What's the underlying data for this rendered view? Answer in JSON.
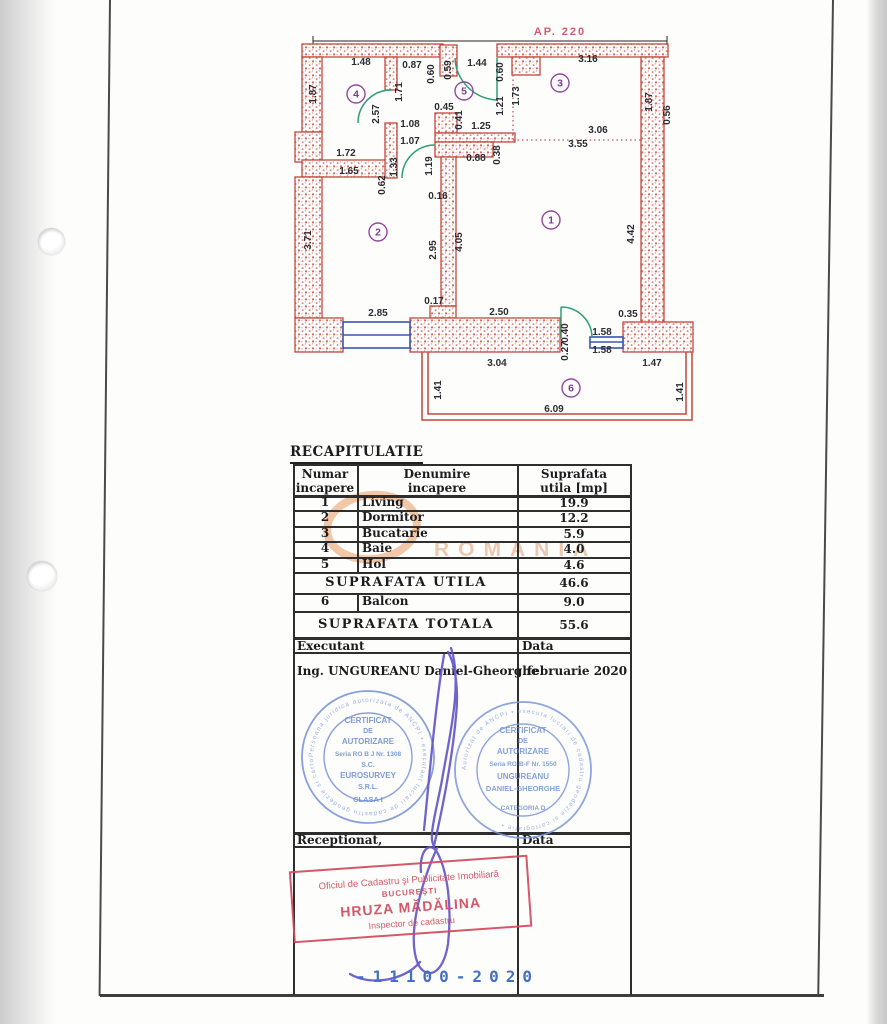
{
  "document": {
    "ap_label": "AP. 220",
    "recap": {
      "title": "RECAPITULATIE",
      "headers": {
        "col1": "Numar\nincapere",
        "col2": "Denumire\nincapere",
        "col3": "Suprafata\nutila [mp]"
      },
      "rows": [
        [
          "1",
          "Living",
          "19.9"
        ],
        [
          "2",
          "Dormitor",
          "12.2"
        ],
        [
          "3",
          "Bucatarie",
          "5.9"
        ],
        [
          "4",
          "Baie",
          "4.0"
        ],
        [
          "5",
          "Hol",
          "4.6"
        ]
      ],
      "suprafata_utila_label": "SUPRAFATA  UTILA",
      "suprafata_utila_value": "46.6",
      "balcon_row": [
        "6",
        "Balcon",
        "9.0"
      ],
      "suprafata_totala_label": "SUPRAFATA  TOTALA",
      "suprafata_totala_value": "55.6"
    },
    "executant": {
      "label": "Executant",
      "data_label": "Data",
      "name": "Ing. UNGUREANU Daniel-Gheorghe",
      "date": "februarie  2020"
    },
    "receptionat": {
      "label": "Receptionat,",
      "data_label": "Data"
    },
    "stamp_round_1": {
      "lines": [
        "CERTIFICAT",
        "DE",
        "AUTORIZARE",
        "Seria RO  B  J Nr. 1308",
        "S.C.",
        "EUROSURVEY",
        "S.R.L.",
        "CLASA I"
      ],
      "ring_text": "Persoana juridica autorizata de ANCPI • executant lucrari de cadastru geodezie si cartografie •"
    },
    "stamp_round_2": {
      "lines": [
        "CERTIFICAT",
        "DE",
        "AUTORIZARE",
        "Seria RO-B-F Nr. 1550",
        "UNGUREANU",
        "DANIEL-GHEORGHE"
      ],
      "bottom_arc": "CATEGORIA D",
      "ring_text": "Autorizat de ANCPI • executa lucrari de cadastru geodezie si cartografie •"
    },
    "stamp_rect": {
      "line1": "Oficiul de Cadastru şi Publicitate Imobiliară",
      "line2": "BUCUREŞTI",
      "line3": "HRUZA MĂDĂLINA",
      "line4": "Inspector de cadastru"
    },
    "registration_number": "-11100-2020",
    "watermark": "ROMANIA"
  },
  "plan": {
    "colors": {
      "wall": "#c4473c",
      "door": "#2f9e74",
      "window": "#3b55b5",
      "dim_text": "#2c2c34",
      "room_circle": "#93489c",
      "dotted": "#cc4a55"
    },
    "room_circles": [
      {
        "n": "1",
        "x": 551,
        "y": 220
      },
      {
        "n": "2",
        "x": 378,
        "y": 232
      },
      {
        "n": "3",
        "x": 560,
        "y": 83
      },
      {
        "n": "4",
        "x": 356,
        "y": 94
      },
      {
        "n": "5",
        "x": 464,
        "y": 91
      },
      {
        "n": "6",
        "x": 571,
        "y": 388
      }
    ],
    "labels": [
      {
        "t": "1.48",
        "x": 361,
        "y": 65
      },
      {
        "t": "0.87",
        "x": 412,
        "y": 68
      },
      {
        "t": "0.60",
        "x": 434,
        "y": 74,
        "v": 1
      },
      {
        "t": "0.59",
        "x": 451,
        "y": 70,
        "v": 1
      },
      {
        "t": "1.44",
        "x": 477,
        "y": 66
      },
      {
        "t": "0.60",
        "x": 503,
        "y": 72,
        "v": 1
      },
      {
        "t": "3.16",
        "x": 588,
        "y": 62
      },
      {
        "t": "1.87",
        "x": 316,
        "y": 94,
        "v": 1
      },
      {
        "t": "2.57",
        "x": 379,
        "y": 114,
        "v": 1
      },
      {
        "t": "1.71",
        "x": 402,
        "y": 92,
        "v": 1
      },
      {
        "t": "1.21",
        "x": 503,
        "y": 106,
        "v": 1
      },
      {
        "t": "1.73",
        "x": 519,
        "y": 96,
        "v": 1
      },
      {
        "t": "1.87",
        "x": 652,
        "y": 102,
        "v": 1
      },
      {
        "t": "0.56",
        "x": 670,
        "y": 115,
        "v": 1
      },
      {
        "t": "1.08",
        "x": 410,
        "y": 127
      },
      {
        "t": "1.07",
        "x": 410,
        "y": 144
      },
      {
        "t": "0.45",
        "x": 444,
        "y": 110
      },
      {
        "t": "0.41",
        "x": 462,
        "y": 120,
        "v": 1
      },
      {
        "t": "1.25",
        "x": 481,
        "y": 129
      },
      {
        "t": "3.06",
        "x": 598,
        "y": 133
      },
      {
        "t": "3.55",
        "x": 578,
        "y": 147
      },
      {
        "t": "0.88",
        "x": 476,
        "y": 161
      },
      {
        "t": "0.38",
        "x": 500,
        "y": 155,
        "v": 1
      },
      {
        "t": "1.72",
        "x": 346,
        "y": 156
      },
      {
        "t": "1.65",
        "x": 349,
        "y": 174
      },
      {
        "t": "0.62",
        "x": 385,
        "y": 185,
        "v": 1
      },
      {
        "t": "1.33",
        "x": 397,
        "y": 167,
        "v": 1
      },
      {
        "t": "1.19",
        "x": 432,
        "y": 166,
        "v": 1
      },
      {
        "t": "0.16",
        "x": 438,
        "y": 199
      },
      {
        "t": "3.71",
        "x": 311,
        "y": 240,
        "v": 1
      },
      {
        "t": "2.95",
        "x": 436,
        "y": 250,
        "v": 1
      },
      {
        "t": "4.05",
        "x": 462,
        "y": 242,
        "v": 1
      },
      {
        "t": "4.42",
        "x": 634,
        "y": 234,
        "v": 1
      },
      {
        "t": "2.85",
        "x": 378,
        "y": 316
      },
      {
        "t": "0.17",
        "x": 434,
        "y": 304
      },
      {
        "t": "2.50",
        "x": 499,
        "y": 315
      },
      {
        "t": "0.40",
        "x": 568,
        "y": 333,
        "v": 1
      },
      {
        "t": "0.27",
        "x": 568,
        "y": 351,
        "v": 1
      },
      {
        "t": "1.58",
        "x": 602,
        "y": 335
      },
      {
        "t": "1.58",
        "x": 602,
        "y": 353
      },
      {
        "t": "0.35",
        "x": 628,
        "y": 317
      },
      {
        "t": "3.04",
        "x": 497,
        "y": 366
      },
      {
        "t": "1.47",
        "x": 652,
        "y": 366
      },
      {
        "t": "1.41",
        "x": 441,
        "y": 390,
        "v": 1
      },
      {
        "t": "1.41",
        "x": 683,
        "y": 392,
        "v": 1
      },
      {
        "t": "6.09",
        "x": 554,
        "y": 412
      }
    ]
  }
}
